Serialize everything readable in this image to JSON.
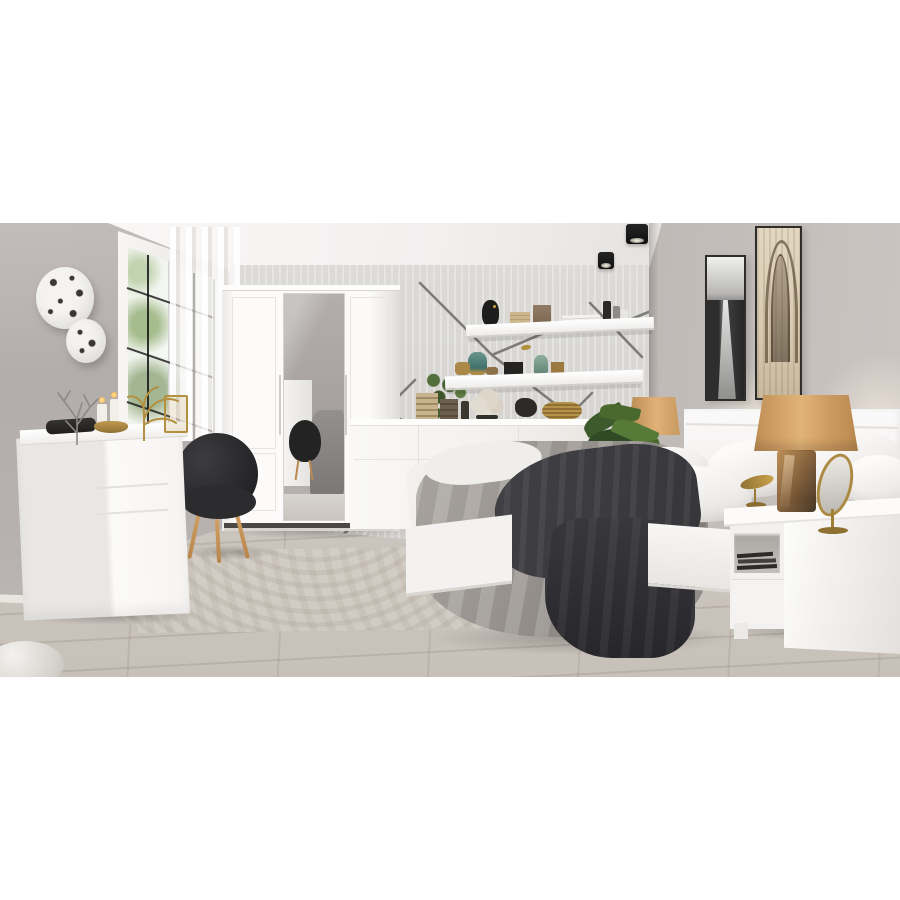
{
  "meta": {
    "type": "product-photo",
    "label": "Showroom photograph of a modern bedroom with a white high-gloss furniture set, photo centered on white background"
  },
  "palette": {
    "wallpaper": "#d6d4d1",
    "branch": "#7e7c7a",
    "wall-left": "#b2acaa",
    "wall-right": "#a9a3a0",
    "ceiling": "#f2f0ef",
    "floor": "#c7c1ba",
    "rug": "#cfc9c1",
    "white": "#f9f8f7",
    "chair": "#2c2b2d",
    "wood": "#c2945c",
    "shade": "#cf9d63",
    "gold": "#ad8a43",
    "duvet": "#a09b96",
    "throw": "#36363a",
    "plant": "#47642f",
    "sepia": "#d8cab1",
    "frame": "#2e2d2c"
  },
  "scene": {
    "room": {
      "label": "Bedroom interior with grey walls, branch-pattern wallpaper, wood floor and patterned rug"
    },
    "furniture": {
      "wardrobe": {
        "label": "White three-door wardrobe with centre mirror door"
      },
      "dresser": {
        "label": "White high-gloss chest of drawers with decor on top"
      },
      "chair": {
        "label": "Black upholstered accent chair with wooden legs"
      },
      "sideboard": {
        "label": "White low sideboard behind the bed"
      },
      "bed": {
        "label": "White double bed with grey duvet, dark throw and white pillows"
      },
      "headboard": {
        "label": "White bed headboard"
      },
      "nightstand": {
        "label": "White bedside table with open shelf holding books"
      },
      "shelf_upper": {
        "label": "White wall shelf with head sculpture, books, box and bottles"
      },
      "shelf_lower": {
        "label": "White wall shelf with vases, boxes and trailing plant"
      }
    },
    "decor": {
      "window": {
        "label": "White casement window with black muntin grid and sheer curtain"
      },
      "plates": {
        "label": "Two round white wall plates with black speckles"
      },
      "art_bw": {
        "label": "Black and white canyon artwork in dark frame"
      },
      "art_sepia": {
        "label": "Sepia gothic arch artwork in dark frame"
      },
      "spotlights": {
        "label": "Two black cube ceiling spotlights"
      },
      "lamp_left": {
        "label": "Table lamp with tan shade and gold stand beside headboard"
      },
      "lamp_right": {
        "label": "Table lamp with tan shade and amber glass base on nightstand"
      },
      "vanity_mirror": {
        "label": "Gold oval table mirror on nightstand"
      },
      "plant": {
        "label": "Green leafy plant beside the bed"
      },
      "coral_silver": {
        "label": "Silver coral branch ornament on dresser"
      },
      "coral_white": {
        "label": "White coral ornament on sideboard"
      },
      "candles": {
        "label": "Lit pillar candles on dresser"
      },
      "gold_decor": {
        "label": "Gold bowl, plant sculpture and miniature chair on dresser"
      },
      "gold_bird": {
        "label": "Small gold bird sculpture on bed rail"
      },
      "rug": {
        "label": "Light grey distressed-pattern area rug"
      },
      "pouf": {
        "label": "Edge of a light pouf in the lower-left corner"
      }
    }
  }
}
